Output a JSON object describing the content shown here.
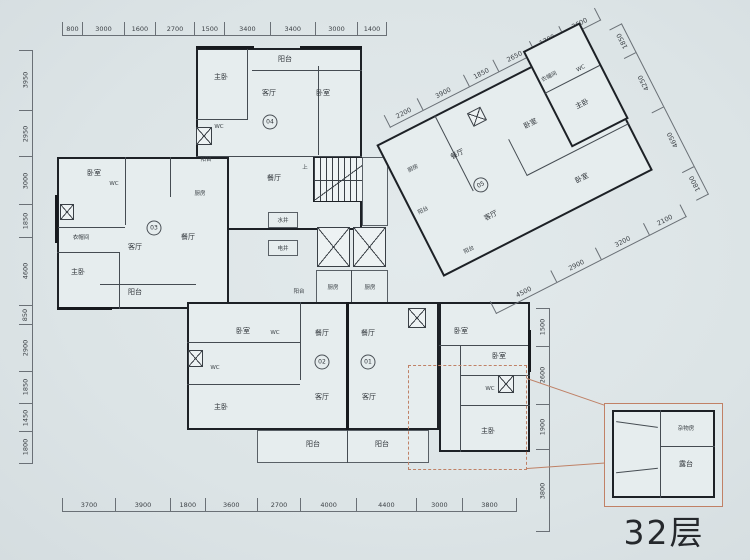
{
  "caption": "32层",
  "dims": {
    "top": [
      "800",
      "3000",
      "1600",
      "2700",
      "1500",
      "3400",
      "3400",
      "3000",
      "1400"
    ],
    "left": [
      "3950",
      "2950",
      "3000",
      "1850",
      "4600",
      "850",
      "2900",
      "1850",
      "1450",
      "1800"
    ],
    "bottom": [
      "3700",
      "3900",
      "1800",
      "3600",
      "2700",
      "4000",
      "4400",
      "3000",
      "3800"
    ],
    "right_mid": [
      "1500",
      "2600",
      "1900",
      "3800"
    ],
    "wing_top": [
      "2200",
      "3900",
      "1850",
      "2650",
      "1700",
      "2600"
    ],
    "wing_right": [
      "1850",
      "4250",
      "4650",
      "1800"
    ],
    "wing_bottom": [
      "4500",
      "2900",
      "3200",
      "2100"
    ]
  },
  "rooms": {
    "master": "主卧",
    "bedroom": "卧室",
    "living": "客厅",
    "dining": "餐厅",
    "kitchen": "厨房",
    "balcony": "阳台",
    "cloakroom": "衣帽间",
    "wc": "WC",
    "water_shaft": "水井",
    "elec_shaft": "电井",
    "storage": "杂物房",
    "terrace": "露台",
    "stairs_up": "上",
    "stairs_down": "下"
  },
  "units": {
    "u01": "01",
    "u02": "02",
    "u03": "03",
    "u04": "04",
    "u05": "05"
  },
  "colors": {
    "paper": "#dce4e6",
    "wall": "#1d2126",
    "accent": "#c18166"
  }
}
